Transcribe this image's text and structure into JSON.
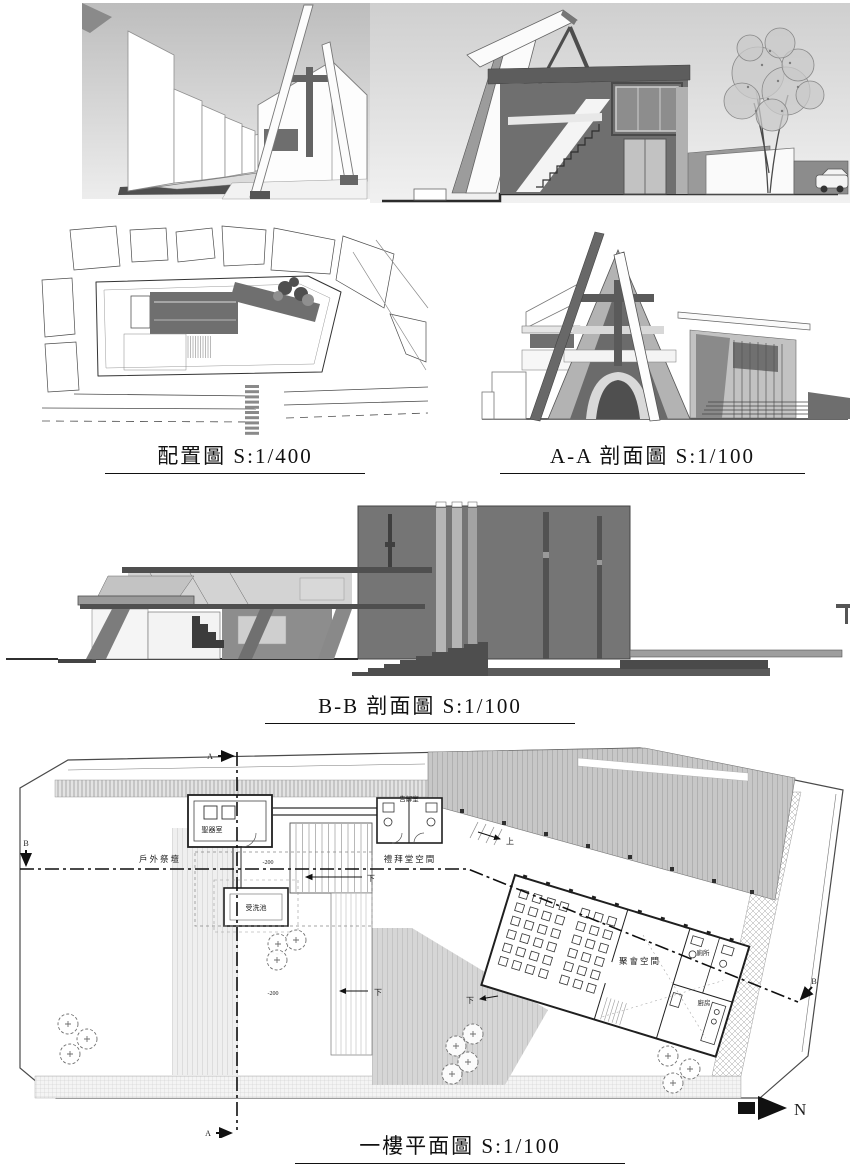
{
  "panels": {
    "street_perspective": {
      "kind": "rendering"
    },
    "sectional_perspective": {
      "kind": "rendering"
    },
    "site_plan": {
      "title": "配置圖 S:1/400"
    },
    "section_aa": {
      "title": "A-A 剖面圖 S:1/100"
    },
    "section_bb": {
      "title": "B-B 剖面圖 S:1/100"
    },
    "floor_plan": {
      "title": "一樓平面圖 S:1/100",
      "rooms": {
        "vestry": "聖器室",
        "confession": "告解室",
        "outdoor_altar": "戶外祭壇",
        "chapel": "禮拜堂空間",
        "baptismal_font": "受洗池",
        "assembly": "聚會空間",
        "toilet": "廁所",
        "kitchen": "廚房"
      },
      "levels": {
        "plaza": "-200",
        "court": "-200"
      },
      "stairs": {
        "up": "上",
        "down": "下"
      },
      "markers": {
        "a": "A",
        "b": "B"
      },
      "north": "N"
    }
  },
  "colors": {
    "paper": "#ffffff",
    "line": "#2f2f2f",
    "poche_dark": "#6e6e6e",
    "poche_mid": "#9a9a9a",
    "poche_light": "#c8c8c8",
    "sky": "#c8c8c8"
  }
}
